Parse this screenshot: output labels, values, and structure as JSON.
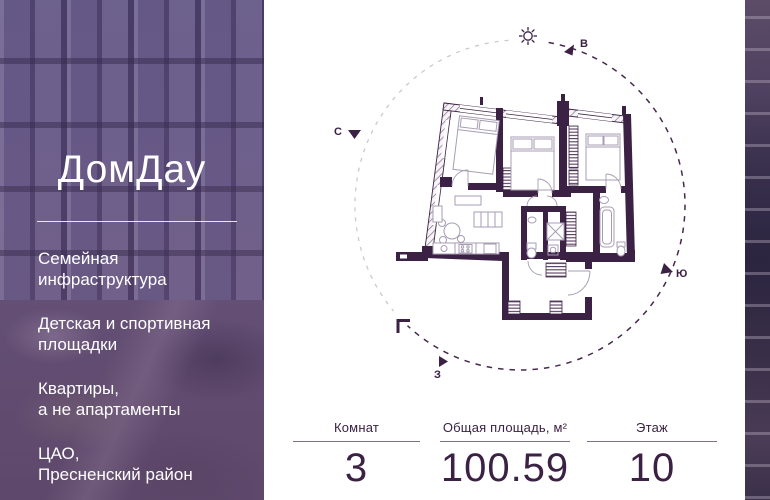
{
  "brand": {
    "logo": "ДомДау"
  },
  "sidebar": {
    "features": [
      "Семейная\nинфраструктура",
      "Детская и спортивная\nплощадки",
      "Квартиры,\nа не апартаменты",
      "ЦАО,\nПресненский район"
    ]
  },
  "compass": {
    "east": "В",
    "north": "С",
    "south": "Ю",
    "west": "З"
  },
  "stats": {
    "columns": [
      {
        "label": "Комнат",
        "value": "3"
      },
      {
        "label": "Общая площадь, м²",
        "value": "100.59"
      },
      {
        "label": "Этаж",
        "value": "10"
      }
    ]
  },
  "colors": {
    "accent_dark_purple": "#3b2144",
    "arc_light_gray": "#ccc8d2",
    "sidebar_overlay": "#5a4c72"
  }
}
